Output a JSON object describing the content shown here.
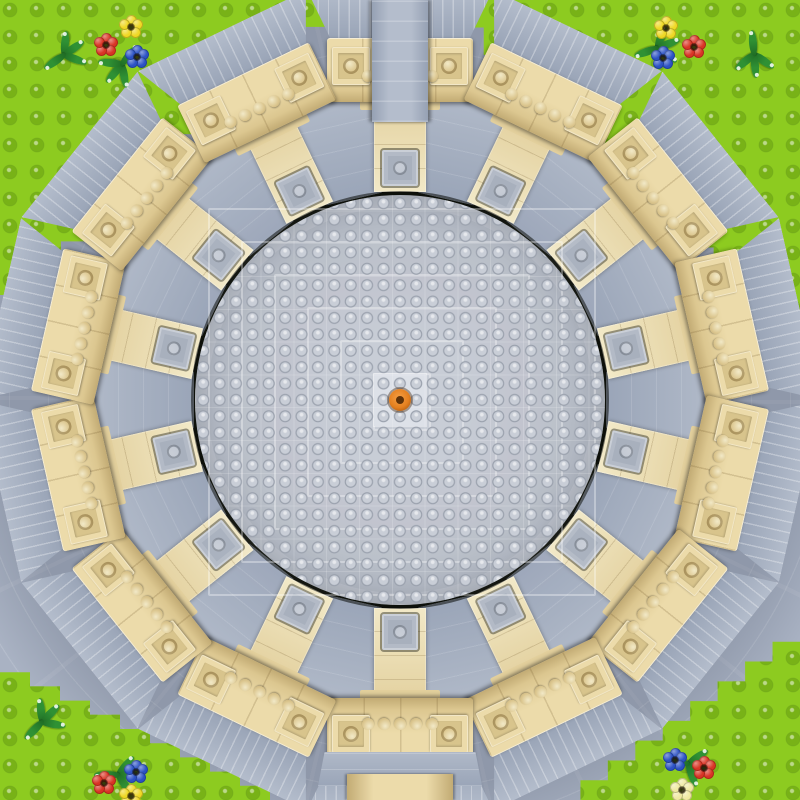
{
  "scene": {
    "name": "brick-model-round-temple-top-view",
    "canvas": {
      "w": 800,
      "h": 800
    },
    "center": {
      "x": 400,
      "y": 400
    },
    "colors": {
      "green_base": "#8dcb20",
      "green_stud": "#78b217",
      "stud_hi": "rgba(255,255,255,0.55)",
      "plaza": "#a9b2c3",
      "plaza_line": "rgba(255,255,255,0.13)",
      "dark_inner": "#171b12",
      "dark_outer": "#0a0d08",
      "wedge_l": "#b4bdcc",
      "wedge_d": "#96a1b4",
      "rib": "rgba(255,255,255,0.30)",
      "slope_l": "#b0b9c8",
      "slope_d": "#9aa5b8",
      "wall_l": "#ecdbaa",
      "wall_m": "#dcc790",
      "wall_d": "#c2ab74",
      "wall_seam": "rgba(120,95,50,0.22)",
      "pad_in": "#d8c48c",
      "stem_l": "#f2e9c7",
      "stem_m": "#e2cf9c",
      "tile_f": "#b3bac6",
      "tile_in": "#a8b0bd",
      "tile_stud": "#c4cad4",
      "dome": "#b7bdc8",
      "dome_stud": "#c9ced7",
      "dome_stud_sh": "#99a0ac",
      "dome_line": "rgba(255,255,255,0.16)",
      "dome_center": "#dde1e8",
      "orange": "#e4801f",
      "orange_hi": "#f59f45",
      "orange_core": "#5e3209",
      "leaf": "#2f9134",
      "leaf_d": "#1f6b24",
      "f_red": "#d93425",
      "f_yellow": "#efd824",
      "f_blue": "#2c52c4",
      "f_pale": "#efe9a0"
    },
    "ring": {
      "segments": 14,
      "angle_offset_deg": -90,
      "dark_radius": 318,
      "wedge": {
        "w": 186,
        "h": 54,
        "out": 410
      },
      "wall": {
        "w": 146,
        "h": 64,
        "out": 362
      },
      "pad2x2": {
        "size": 38,
        "inner": 26,
        "stud": 16,
        "inset_x": 5,
        "inset_y": 9
      },
      "studrow": {
        "count": 5,
        "d": 12,
        "gap": 4,
        "y": 32
      },
      "stem": {
        "w": 52,
        "len": 102,
        "out": 310
      },
      "cap": {
        "w": 80,
        "h": 26,
        "out": 316
      },
      "tile": {
        "size": 36,
        "inner": 24,
        "stud": 14,
        "out": 250
      },
      "slope": {
        "w": 94,
        "len": 102,
        "out": 308
      }
    },
    "dome": {
      "radius": 205,
      "stud_pitch": 16.4,
      "plate_rings": [
        54,
        120,
        186,
        252,
        318,
        384
      ],
      "center_plate": 52,
      "orange_d": 22,
      "orange_core_d": 8
    },
    "walkways": {
      "top": {
        "x": 372,
        "y": 0,
        "w": 56,
        "h": 122
      },
      "bottom_apron": {
        "x": 318,
        "y": 752,
        "w": 164,
        "h": 34
      },
      "bottom": {
        "x": 347,
        "y": 774,
        "w": 106,
        "h": 26
      }
    },
    "corners": [
      {
        "id": "top-left",
        "ax": 0,
        "ay": 0,
        "p1": [
          335,
          0
        ],
        "p2": [
          0,
          295
        ],
        "steps": 11
      },
      {
        "id": "top-right",
        "ax": 800,
        "ay": 0,
        "p1": [
          455,
          0
        ],
        "p2": [
          800,
          330
        ],
        "steps": 12
      },
      {
        "id": "bottom-left",
        "ax": 0,
        "ay": 800,
        "p1": [
          0,
          658
        ],
        "p2": [
          300,
          800
        ],
        "steps": 10
      },
      {
        "id": "bottom-right",
        "ax": 800,
        "ay": 800,
        "p1": [
          800,
          622
        ],
        "p2": [
          553,
          800
        ],
        "steps": 9
      }
    ],
    "plants": [
      {
        "x": 62,
        "y": 55,
        "rot": -25
      },
      {
        "x": 120,
        "y": 64,
        "rot": 140
      },
      {
        "x": 655,
        "y": 48,
        "rot": -10
      },
      {
        "x": 752,
        "y": 54,
        "rot": 95
      },
      {
        "x": 40,
        "y": 722,
        "rot": -35
      },
      {
        "x": 116,
        "y": 775,
        "rot": 10
      },
      {
        "x": 686,
        "y": 764,
        "rot": 25
      }
    ],
    "flowers": [
      {
        "x": 106,
        "y": 45,
        "color": "f_red"
      },
      {
        "x": 131,
        "y": 27,
        "color": "f_yellow"
      },
      {
        "x": 137,
        "y": 57,
        "color": "f_blue"
      },
      {
        "x": 666,
        "y": 28,
        "color": "f_yellow"
      },
      {
        "x": 694,
        "y": 47,
        "color": "f_red"
      },
      {
        "x": 663,
        "y": 58,
        "color": "f_blue"
      },
      {
        "x": 104,
        "y": 783,
        "color": "f_red"
      },
      {
        "x": 136,
        "y": 772,
        "color": "f_blue"
      },
      {
        "x": 131,
        "y": 796,
        "color": "f_yellow"
      },
      {
        "x": 675,
        "y": 760,
        "color": "f_blue"
      },
      {
        "x": 704,
        "y": 768,
        "color": "f_red"
      },
      {
        "x": 682,
        "y": 790,
        "color": "f_pale"
      }
    ]
  }
}
